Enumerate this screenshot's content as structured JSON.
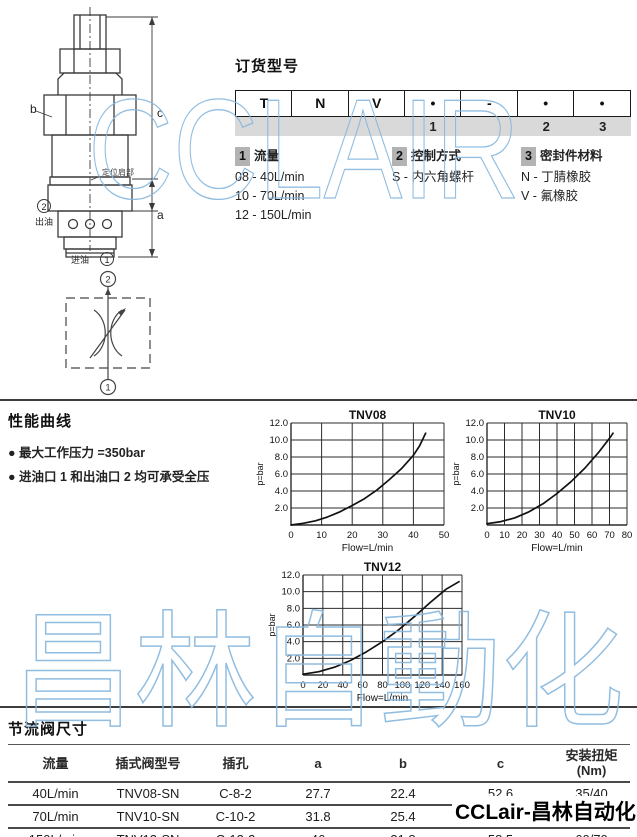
{
  "watermarks": {
    "top": "CCLAIR",
    "middle": "昌林自動化",
    "bottom_right": "CCLair-昌林自动化",
    "blue": "#85b6dd"
  },
  "drawing": {
    "label_b": "b",
    "label_c": "c",
    "label_a": "a",
    "shoulder_label": "定位肩部",
    "port2_num": "2",
    "port2_label": "出油",
    "port1_label": "进油",
    "port1_num": "1",
    "symbol_port_top": "2",
    "symbol_port_bottom": "1"
  },
  "ordering": {
    "title": "订货型号",
    "code_cells": [
      "T",
      "N",
      "V",
      "•",
      "-",
      "•",
      "•"
    ],
    "code_positions": [
      "",
      "",
      "",
      "1",
      "",
      "2",
      "3"
    ],
    "groups": [
      {
        "num": "1",
        "title": "流量",
        "items": [
          "08 - 40L/min",
          "10 - 70L/min",
          "12 - 150L/min"
        ]
      },
      {
        "num": "2",
        "title": "控制方式",
        "items": [
          "S - 内六角螺杆"
        ]
      },
      {
        "num": "3",
        "title": "密封件材料",
        "items": [
          "N - 丁腈橡胶",
          "V - 氟橡胶"
        ]
      }
    ]
  },
  "performance": {
    "title": "性能曲线",
    "bullets": [
      "● 最大工作压力 =350bar",
      "● 进油口 1 和出油口 2 均可承受全压"
    ]
  },
  "chart_data": [
    {
      "type": "line",
      "title": "TNV08",
      "xlabel": "Flow=L/min",
      "ylabel": "p=bar",
      "xlim": [
        0,
        50
      ],
      "ylim": [
        0,
        12
      ],
      "xticks": [
        0,
        10,
        20,
        30,
        40,
        50
      ],
      "yticks": [
        2,
        4,
        6,
        8,
        10,
        12
      ],
      "grid": true,
      "legend": "none",
      "curve": [
        [
          0,
          0
        ],
        [
          4,
          0.2
        ],
        [
          8,
          0.5
        ],
        [
          12,
          0.95
        ],
        [
          16,
          1.55
        ],
        [
          20,
          2.3
        ],
        [
          24,
          3.1
        ],
        [
          28,
          4.1
        ],
        [
          32,
          5.3
        ],
        [
          36,
          6.6
        ],
        [
          40,
          8.2
        ],
        [
          42,
          9.3
        ],
        [
          44,
          10.8
        ]
      ]
    },
    {
      "type": "line",
      "title": "TNV10",
      "xlabel": "Flow=L/min",
      "ylabel": "p=bar",
      "xlim": [
        0,
        80
      ],
      "ylim": [
        0,
        12
      ],
      "xticks": [
        0,
        10,
        20,
        30,
        40,
        50,
        60,
        70,
        80
      ],
      "yticks": [
        2,
        4,
        6,
        8,
        10,
        12
      ],
      "grid": true,
      "legend": "none",
      "curve": [
        [
          0,
          0.15
        ],
        [
          8,
          0.4
        ],
        [
          16,
          0.85
        ],
        [
          24,
          1.55
        ],
        [
          32,
          2.5
        ],
        [
          40,
          3.7
        ],
        [
          48,
          5.1
        ],
        [
          56,
          6.7
        ],
        [
          64,
          8.6
        ],
        [
          70,
          10.2
        ],
        [
          72,
          10.8
        ]
      ]
    },
    {
      "type": "line",
      "title": "TNV12",
      "xlabel": "Flow=L/min",
      "ylabel": "p=bar",
      "xlim": [
        0,
        160
      ],
      "ylim": [
        0,
        12
      ],
      "xticks": [
        0,
        20,
        40,
        60,
        80,
        100,
        120,
        140,
        160
      ],
      "yticks": [
        2,
        4,
        6,
        8,
        10,
        12
      ],
      "grid": true,
      "legend": "none",
      "curve": [
        [
          0,
          0.1
        ],
        [
          16,
          0.4
        ],
        [
          32,
          0.95
        ],
        [
          48,
          1.75
        ],
        [
          64,
          2.8
        ],
        [
          80,
          4.0
        ],
        [
          96,
          5.4
        ],
        [
          112,
          7.0
        ],
        [
          128,
          8.7
        ],
        [
          144,
          10.3
        ],
        [
          157,
          11.2
        ]
      ]
    }
  ],
  "dimensions": {
    "title": "节流阀尺寸",
    "headers": [
      "流量",
      "插式阀型号",
      "插孔",
      "a",
      "b",
      "c",
      "安装扭矩\n(Nm)"
    ],
    "rows": [
      [
        "40L/min",
        "TNV08-SN",
        "C-8-2",
        "27.7",
        "22.4",
        "52.6",
        "35/40"
      ],
      [
        "70L/min",
        "TNV10-SN",
        "C-10-2",
        "31.8",
        "25.4",
        "52.6",
        "40/50"
      ],
      [
        "150L/min",
        "TNV12-SN",
        "C-12-2",
        "46",
        "31.8",
        "58.5",
        "60/70"
      ]
    ]
  }
}
